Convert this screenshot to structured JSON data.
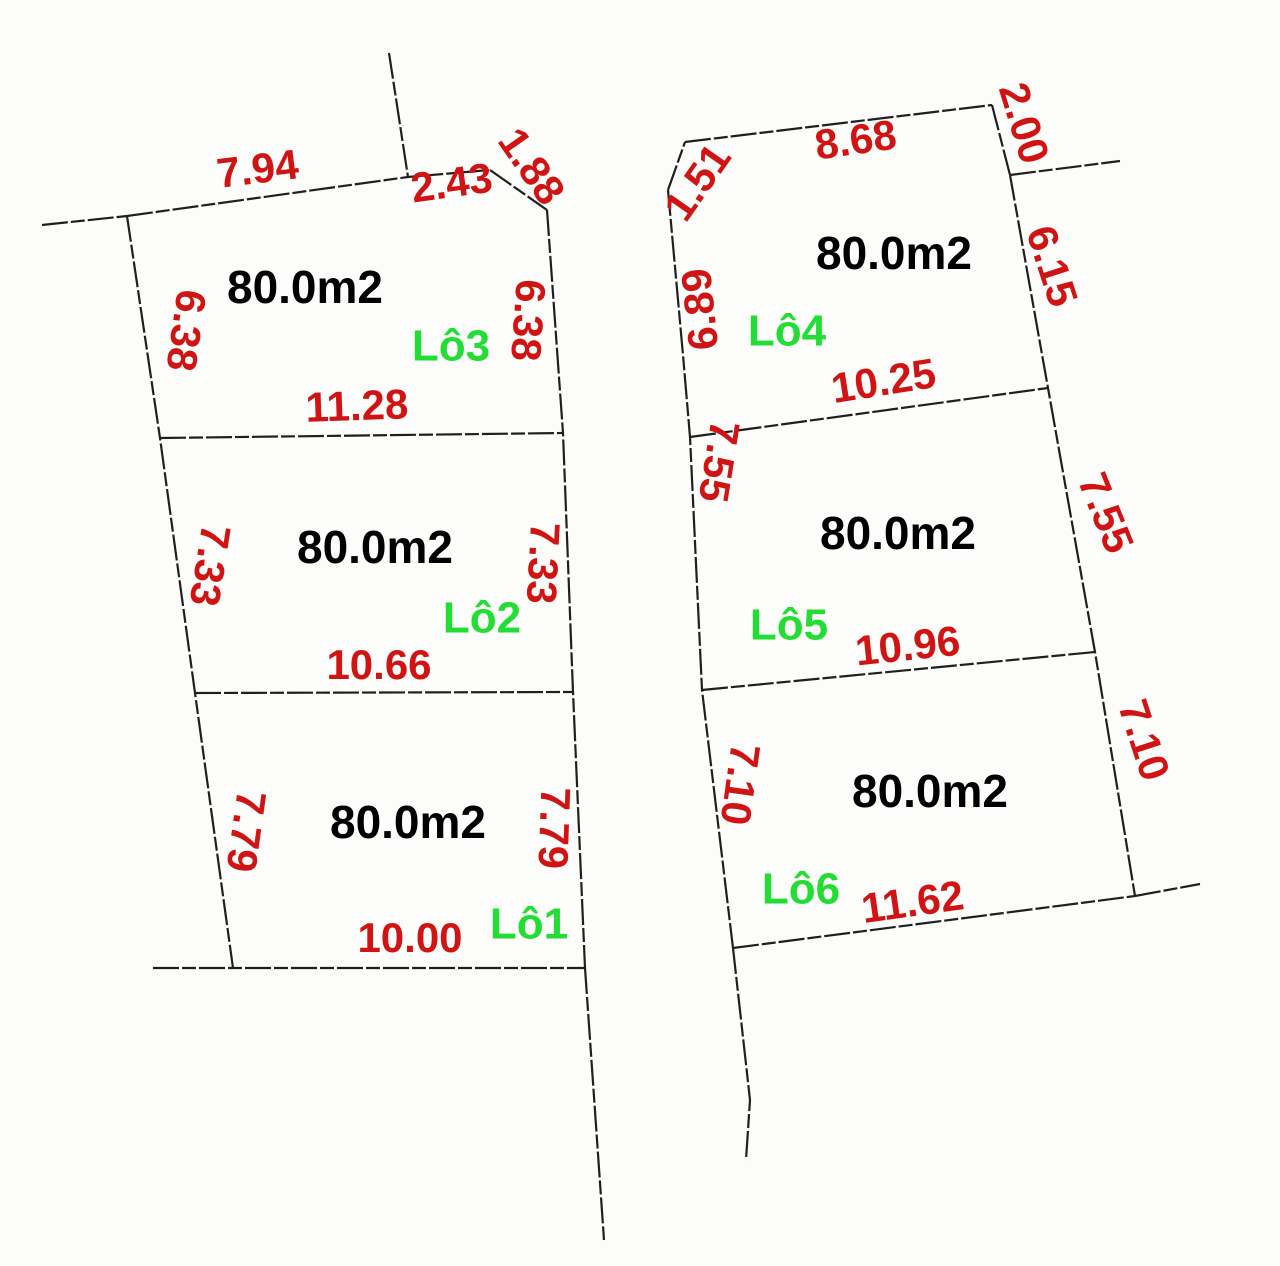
{
  "diagram": {
    "type": "cadastral-subdivision-plan",
    "colors": {
      "background": "#fcfcfa",
      "line": "#1f1f1f",
      "dimension": "#d01414",
      "area_text": "#000000",
      "lot_name": "#22dd33"
    },
    "lots": [
      {
        "name": "Lô1",
        "area": "80.0m2",
        "side_left": "7.79",
        "side_right": "7.79",
        "side_top": "10.66",
        "side_bottom": "10.00"
      },
      {
        "name": "Lô2",
        "area": "80.0m2",
        "side_left": "7.33",
        "side_right": "7.33",
        "side_top": "11.28",
        "side_bottom": "10.66"
      },
      {
        "name": "Lô3",
        "area": "80.0m2",
        "side_left": "6.38",
        "side_right": "6.38",
        "side_top_segments": [
          "7.94",
          "2.43",
          "1.88"
        ],
        "side_bottom": "11.28"
      },
      {
        "name": "Lô4",
        "area": "80.0m2",
        "side_left": "6.89",
        "corner_cut": "1.51",
        "side_top": "8.68",
        "side_right_upper": "2.00",
        "side_right": "6.15",
        "side_bottom": "10.25"
      },
      {
        "name": "Lô5",
        "area": "80.0m2",
        "side_left": "7.55",
        "side_right": "7.55",
        "side_top": "10.25",
        "side_bottom": "10.96"
      },
      {
        "name": "Lô6",
        "area": "80.0m2",
        "side_left": "7.10",
        "side_right": "7.10",
        "side_top": "10.96",
        "side_bottom": "11.62"
      }
    ],
    "labels": [
      {
        "text": "7.94",
        "kind": "dimension",
        "x": 258,
        "y": 172,
        "rot": -7
      },
      {
        "text": "2.43",
        "kind": "dimension",
        "x": 452,
        "y": 186,
        "rot": -8
      },
      {
        "text": "1.88",
        "kind": "dimension",
        "x": 529,
        "y": 168,
        "rot": 55
      },
      {
        "text": "6.38",
        "kind": "dimension",
        "x": 183,
        "y": 330,
        "rot": 98
      },
      {
        "text": "6.38",
        "kind": "dimension",
        "x": 525,
        "y": 320,
        "rot": 94
      },
      {
        "text": "80.0m2",
        "kind": "area",
        "x": 305,
        "y": 291,
        "rot": 0
      },
      {
        "text": "Lô3",
        "kind": "lot-name",
        "x": 451,
        "y": 349,
        "rot": 0
      },
      {
        "text": "11.28",
        "kind": "dimension",
        "x": 357,
        "y": 409,
        "rot": -2
      },
      {
        "text": "7.33",
        "kind": "dimension",
        "x": 207,
        "y": 565,
        "rot": 99
      },
      {
        "text": "7.33",
        "kind": "dimension",
        "x": 540,
        "y": 563,
        "rot": 93
      },
      {
        "text": "80.0m2",
        "kind": "area",
        "x": 375,
        "y": 551,
        "rot": 0
      },
      {
        "text": "Lô2",
        "kind": "lot-name",
        "x": 482,
        "y": 621,
        "rot": 0
      },
      {
        "text": "10.66",
        "kind": "dimension",
        "x": 379,
        "y": 668,
        "rot": 0
      },
      {
        "text": "7.79",
        "kind": "dimension",
        "x": 243,
        "y": 831,
        "rot": 98
      },
      {
        "text": "7.79",
        "kind": "dimension",
        "x": 551,
        "y": 828,
        "rot": 92
      },
      {
        "text": "80.0m2",
        "kind": "area",
        "x": 408,
        "y": 826,
        "rot": 0
      },
      {
        "text": "Lô1",
        "kind": "lot-name",
        "x": 529,
        "y": 927,
        "rot": 0
      },
      {
        "text": "10.00",
        "kind": "dimension",
        "x": 410,
        "y": 941,
        "rot": 0
      },
      {
        "text": "1.51",
        "kind": "dimension",
        "x": 700,
        "y": 184,
        "rot": -55
      },
      {
        "text": "8.68",
        "kind": "dimension",
        "x": 856,
        "y": 143,
        "rot": -8
      },
      {
        "text": "2.00",
        "kind": "dimension",
        "x": 1021,
        "y": 124,
        "rot": 73
      },
      {
        "text": "6.89",
        "kind": "dimension",
        "x": 703,
        "y": 309,
        "rot": -96
      },
      {
        "text": "80.0m2",
        "kind": "area",
        "x": 894,
        "y": 257,
        "rot": 0
      },
      {
        "text": "Lô4",
        "kind": "lot-name",
        "x": 787,
        "y": 334,
        "rot": 0
      },
      {
        "text": "6.15",
        "kind": "dimension",
        "x": 1049,
        "y": 267,
        "rot": 72
      },
      {
        "text": "10.25",
        "kind": "dimension",
        "x": 884,
        "y": 384,
        "rot": -9
      },
      {
        "text": "7.55",
        "kind": "dimension",
        "x": 716,
        "y": 461,
        "rot": 99
      },
      {
        "text": "7.55",
        "kind": "dimension",
        "x": 1103,
        "y": 514,
        "rot": 68
      },
      {
        "text": "80.0m2",
        "kind": "area",
        "x": 898,
        "y": 537,
        "rot": 0
      },
      {
        "text": "Lô5",
        "kind": "lot-name",
        "x": 789,
        "y": 628,
        "rot": 0
      },
      {
        "text": "10.96",
        "kind": "dimension",
        "x": 908,
        "y": 649,
        "rot": -6
      },
      {
        "text": "7.10",
        "kind": "dimension",
        "x": 737,
        "y": 784,
        "rot": 98
      },
      {
        "text": "7.10",
        "kind": "dimension",
        "x": 1141,
        "y": 741,
        "rot": 72
      },
      {
        "text": "80.0m2",
        "kind": "area",
        "x": 930,
        "y": 795,
        "rot": 0
      },
      {
        "text": "Lô6",
        "kind": "lot-name",
        "x": 801,
        "y": 892,
        "rot": 0
      },
      {
        "text": "11.62",
        "kind": "dimension",
        "x": 913,
        "y": 905,
        "rot": -8
      }
    ]
  }
}
